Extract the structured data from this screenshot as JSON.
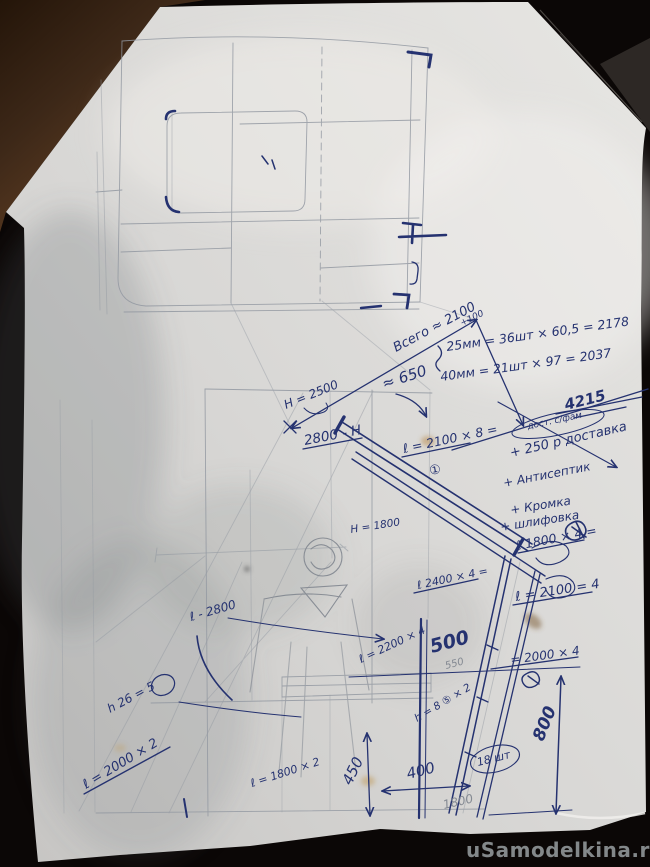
{
  "watermark": "uSamodelkina.ru",
  "colors": {
    "ink": "#253270",
    "pencil": "#9298a1",
    "paper": "#d9d8d6",
    "background": "#0b0706",
    "watermark_gray": "#8f9496"
  },
  "notes": {
    "total": "Всего ≈ 2100",
    "total_sup": "+100",
    "calc_25mm": "25мм = 36шт × 60,5 = 2178",
    "calc_40mm": "40мм = 21шт × 97 = 2037",
    "sum_total": "4215",
    "oval_note": "дост. с/фам",
    "extra_1": "+ 250 р доставка",
    "extra_2": "+ Антисептик",
    "extra_3": "+ Кромка",
    "extra_4": "+ шлифовка",
    "l1800x4": "ℓ 1800 × 4 ="
  },
  "dims": {
    "h2500": "H = 2500",
    "beam2800": "2800 - Н",
    "approx650": "≈ 650",
    "l2100x8": "ℓ = 2100 × 8 =",
    "item1": "①",
    "h1800": "H = 1800",
    "l2400x4": "ℓ 2400 × 4 =",
    "l2100_4": "ℓ = 2100 = 4",
    "l2800": "ℓ - 2800",
    "l2200x4": "ℓ = 2200 × 4",
    "d500": "500",
    "d550": "550",
    "l2000x4": "= 2000 × 4",
    "h26_5": "h 26 = 5",
    "l2000x2": "ℓ = 2000 × 2",
    "l1800x2": "ℓ = 1800 × 2",
    "d450": "450",
    "d400": "400",
    "h8_5x2": "h = 8 ⑤ × 2",
    "qty18": "18 шт",
    "d1800": "1800",
    "d800": "800"
  }
}
